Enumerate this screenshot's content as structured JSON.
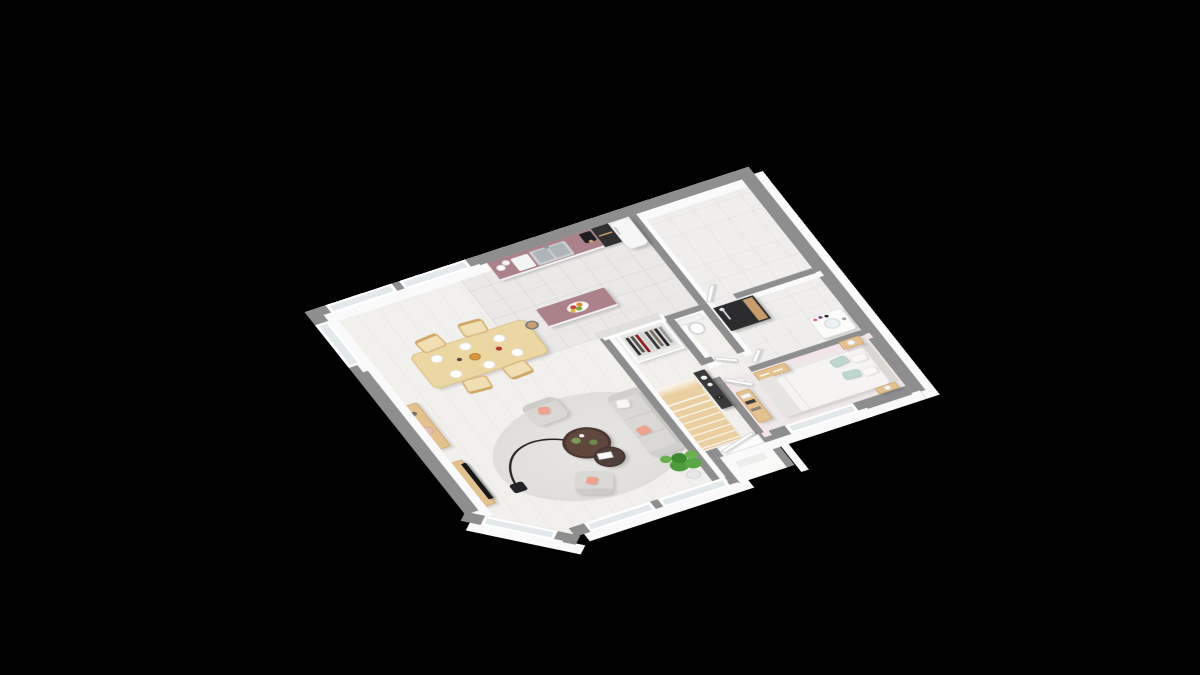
{
  "scene": {
    "description": "3D isometric dollhouse render of a single-storey house floor plan on a black background",
    "projection": {
      "rotate_x_deg": 50,
      "rotate_z_deg": -27,
      "scale": 1.06
    }
  },
  "palette": {
    "background": "#000000",
    "wall_top_gray": "#8e8e8e",
    "wall_face_white": "#fbfbfb",
    "floor_wood": "#f2f0ed",
    "floor_tile": "#eae9e7",
    "bedroom_wall_pink": "#f2e4e8",
    "glass": "#e3e9eb",
    "door_white": "#fdfdfd"
  },
  "styles": {
    "countertop": "#ab8289",
    "island_top": "#ab8289",
    "cabinet_white": "#ececec",
    "appliance_dark": "#2f2e30",
    "fridge_white": "#f6f6f6",
    "stairs_wood": "#ead0a0",
    "dining_wood": "#ead7a2",
    "sofa_gray": "#d9d8d5",
    "pillow_pink": "#efa28f",
    "pillow_mint": "#bed8d1",
    "bed_white": "#f5f4f2",
    "rug_gray": "#e4e2df",
    "coffee_table_brown": "#5f473d",
    "console_dark": "#3a3a3c",
    "shower_dark": "#2c2c2e",
    "shower_wood": "#c59e6c",
    "plant_green": "#4f9c3c",
    "tv_black": "#17171a"
  },
  "rooms": [
    {
      "name": "open-living-dining"
    },
    {
      "name": "kitchen"
    },
    {
      "name": "utility-room"
    },
    {
      "name": "bathroom"
    },
    {
      "name": "wc"
    },
    {
      "name": "dressing-closet"
    },
    {
      "name": "hallway"
    },
    {
      "name": "bedroom"
    },
    {
      "name": "entry-porch"
    },
    {
      "name": "staircase"
    }
  ],
  "furniture": [
    "kitchen-counter-with-sink",
    "kitchen-island-with-fruit-bowl",
    "fridge",
    "tall-oven-column",
    "coffee-machine",
    "bar-stool",
    "dining-table-with-breakfast",
    "dining-chairs",
    "sideboard",
    "tv-bench",
    "tv",
    "arc-floor-lamp",
    "round-rug",
    "nesting-coffee-tables",
    "sofa",
    "armchair",
    "armchair",
    "potted-plant",
    "wardrobe-with-clothes",
    "console-table",
    "staircase-wood",
    "toilet",
    "shower",
    "vanity-sink",
    "double-bed",
    "headboard",
    "nightstand-with-lamp",
    "nightstand-with-lamp",
    "chest-of-drawers",
    "dresser-shelf",
    "floor-lamp"
  ]
}
